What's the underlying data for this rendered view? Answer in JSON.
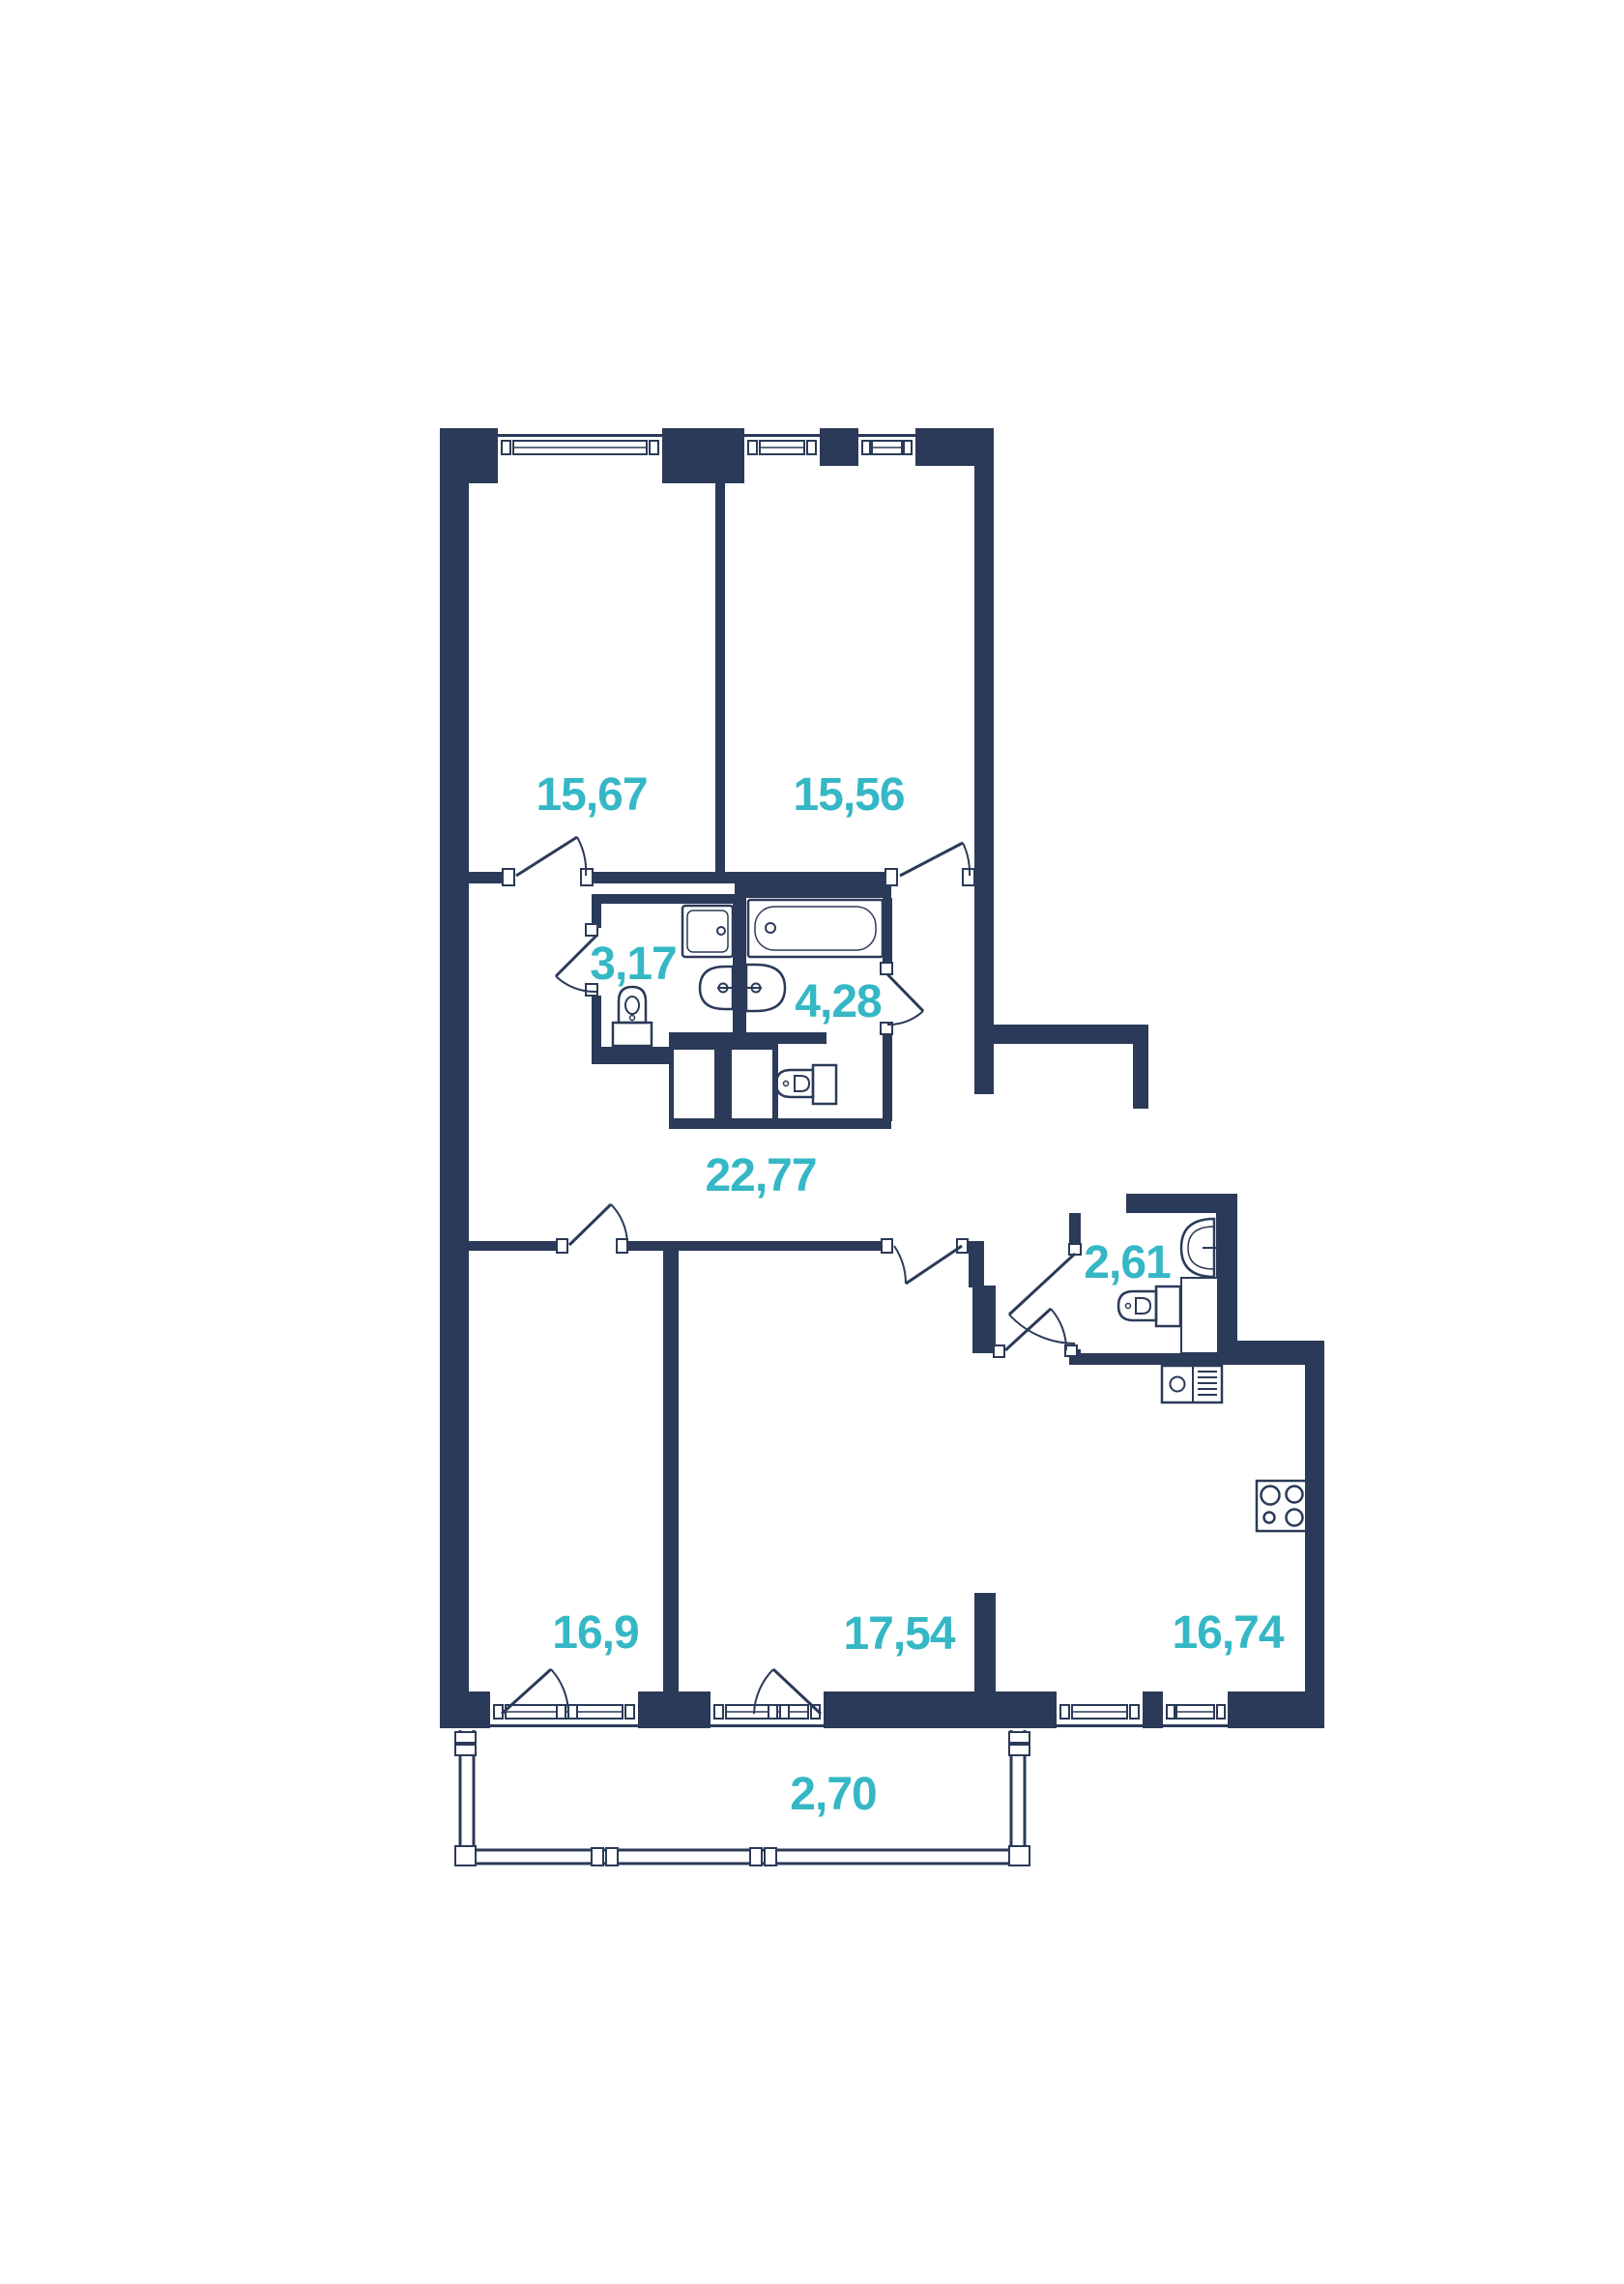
{
  "floor_plan": {
    "colors": {
      "wall": "#2b3a58",
      "label": "#35b7c5",
      "background": "#ffffff"
    },
    "rooms": [
      {
        "id": "bedroom-top-left",
        "area": "15,67"
      },
      {
        "id": "bedroom-top-right",
        "area": "15,56"
      },
      {
        "id": "bathroom-small",
        "area": "3,17"
      },
      {
        "id": "bathroom-large",
        "area": "4,28"
      },
      {
        "id": "hallway",
        "area": "22,77"
      },
      {
        "id": "wc",
        "area": "2,61"
      },
      {
        "id": "room-bottom-left",
        "area": "16,9"
      },
      {
        "id": "room-bottom-middle",
        "area": "17,54"
      },
      {
        "id": "kitchen-living",
        "area": "16,74"
      },
      {
        "id": "balcony",
        "area": "2,70"
      }
    ],
    "fixtures": [
      "shower-cabin",
      "bathtub",
      "double-sink",
      "toilet",
      "toilet",
      "toilet",
      "wash-basin",
      "kitchen-sink",
      "stove",
      "ventilation-shaft",
      "duct"
    ]
  }
}
